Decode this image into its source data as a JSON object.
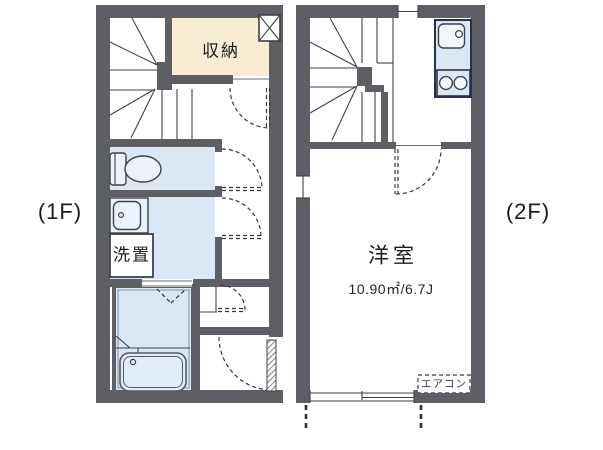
{
  "colors": {
    "wall": "#5e5f64",
    "room-blue": "#dbe7f5",
    "storage-cream": "#f8ecd2",
    "fixture-fill": "#eaf2fb",
    "line": "#3f4248",
    "kitchen-border": "#27314a"
  },
  "floor1": {
    "label": "(1F)",
    "storage_label": "収納",
    "laundry_label": "洗置"
  },
  "floor2": {
    "label": "(2F)",
    "room_name": "洋室",
    "room_area": "10.90㎡/6.7J",
    "aircon_label": "エアコン"
  }
}
